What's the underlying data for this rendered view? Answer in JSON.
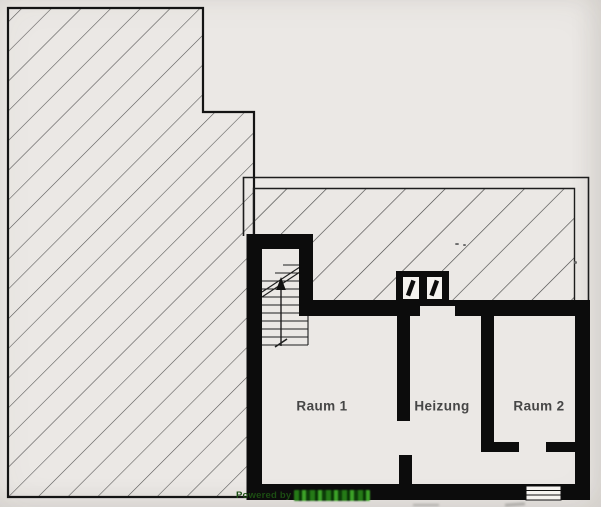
{
  "rooms": [
    {
      "label": "Raum 1"
    },
    {
      "label": "Heizung"
    },
    {
      "label": "Raum 2"
    }
  ],
  "watermark": {
    "powered_by": "Powered by"
  },
  "symbols": {
    "staircase": "staircase-up-arrow",
    "stair_break": "stair-break-line",
    "chimney": "chimney-two-flues",
    "window": "window-in-wall-symbol",
    "hatched_left_area": "adjacent-area-diagonal-hatch",
    "hatched_top_strip": "ground-floor-footprint-diagonal-hatch",
    "walls": "basement-thick-walls"
  },
  "colors": {
    "paper": "#ebe8e5",
    "ink": "#0c0c0c",
    "hatch_line": "#3a3a3a",
    "room_label": "#464646",
    "watermark_green_dark": "#1c4d13",
    "watermark_green_bright": "#49a636"
  }
}
